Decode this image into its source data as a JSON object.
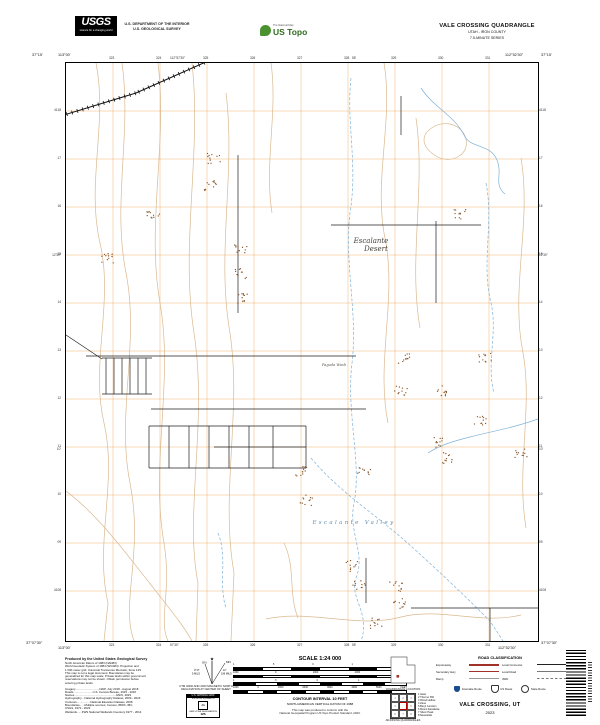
{
  "header": {
    "usgs_wordmark": "USGS",
    "usgs_tagline": "science for a changing world",
    "dept_line1": "U.S. DEPARTMENT OF THE INTERIOR",
    "dept_line2": "U.S. GEOLOGICAL SURVEY",
    "ustopo_tagline": "The National Map",
    "ustopo_brand": "US Topo",
    "quad_title": "VALE CROSSING QUADRANGLE",
    "quad_state": "UTAH - IRON COUNTY",
    "quad_series": "7.5-MINUTE SERIES"
  },
  "map_margin": {
    "corner_tl_lat": "37°15'",
    "corner_tl_lon": "113°00'",
    "corner_tr_lat": "37°15'",
    "corner_tr_lon": "112°52'30\"",
    "corner_bl_lat": "37°07'30\"",
    "corner_bl_lon": "113°00'",
    "corner_br_lat": "37°07'30\"",
    "corner_br_lon": "112°52'30\"",
    "top_ticks": [
      "323",
      "324",
      "325",
      "326",
      "327",
      "328",
      "329",
      "330",
      "331"
    ],
    "bottom_ticks": [
      "323",
      "324",
      "325",
      "326",
      "327",
      "328",
      "329",
      "330",
      "331"
    ],
    "left_ticks": [
      "4118",
      "17",
      "16",
      "15",
      "14",
      "13",
      "12",
      "11",
      "10",
      "09",
      "4108"
    ],
    "right_ticks": [
      "4118",
      "17",
      "16",
      "15",
      "14",
      "13",
      "12",
      "11",
      "10",
      "09",
      "4108"
    ],
    "top_mid_labels": [
      {
        "text": "112°57'30\"",
        "x": 170
      },
      {
        "text": "55'",
        "x": 352
      }
    ],
    "bottom_mid_labels": [
      {
        "text": "57'30\"",
        "x": 170
      },
      {
        "text": "55'",
        "x": 352
      }
    ],
    "left_mid_labels": [
      {
        "text": "12'30\"",
        "y": 253
      },
      {
        "text": "10'",
        "y": 447
      }
    ],
    "right_mid_labels": [
      {
        "text": "12'30\"",
        "y": 253
      },
      {
        "text": "10'",
        "y": 447
      }
    ]
  },
  "map": {
    "colors": {
      "grid": "#f0a55c",
      "contour": "#d8b58a",
      "stream": "#7fb2d8",
      "road": "#1f1f1f",
      "rail": "#111111",
      "speck": "#86562b"
    },
    "labels": [
      {
        "text": "Escalante",
        "x": 305,
        "y": 180,
        "cls": "phys"
      },
      {
        "text": "Desert",
        "x": 310,
        "y": 188,
        "cls": "phys"
      },
      {
        "text": "Pagoda Wash",
        "x": 268,
        "y": 303,
        "cls": "wash"
      },
      {
        "text": "Escalante Valley",
        "x": 288,
        "y": 461,
        "cls": "valley"
      }
    ],
    "features": {
      "grid_vx": [
        47,
        94,
        141,
        188,
        235,
        282,
        329,
        376,
        423
      ],
      "grid_hy": [
        48,
        96,
        144,
        192,
        240,
        288,
        336,
        384,
        432,
        480,
        528
      ],
      "railroad": [
        [
          -2,
          52,
          70,
          30
        ],
        [
          70,
          30,
          142,
          -2
        ]
      ],
      "roads": [
        [
          20,
          293,
          290,
          293
        ],
        [
          85,
          346,
          300,
          346
        ],
        [
          36,
          295,
          86,
          295
        ],
        [
          36,
          331,
          86,
          331
        ],
        [
          40,
          295,
          40,
          331
        ],
        [
          48,
          295,
          48,
          331
        ],
        [
          56,
          295,
          56,
          331
        ],
        [
          64,
          295,
          64,
          331
        ],
        [
          72,
          295,
          72,
          331
        ],
        [
          80,
          295,
          80,
          331
        ],
        [
          0,
          272,
          36,
          296
        ],
        [
          83,
          363,
          240,
          363
        ],
        [
          83,
          405,
          240,
          405
        ],
        [
          148,
          384,
          240,
          384
        ],
        [
          83,
          363,
          83,
          405
        ],
        [
          103,
          363,
          103,
          405
        ],
        [
          123,
          363,
          123,
          405
        ],
        [
          143,
          363,
          143,
          405
        ],
        [
          163,
          363,
          163,
          405
        ],
        [
          183,
          363,
          183,
          405
        ],
        [
          207,
          363,
          207,
          405
        ],
        [
          240,
          363,
          240,
          405
        ],
        [
          172,
          92,
          172,
          250
        ],
        [
          370,
          158,
          370,
          240
        ],
        [
          265,
          162,
          415,
          162
        ],
        [
          335,
          33,
          335,
          72
        ],
        [
          345,
          545,
          472,
          545
        ],
        [
          424,
          545,
          424,
          578
        ],
        [
          300,
          495,
          300,
          540
        ]
      ],
      "contours": [
        "M30,0 C42,60 20,120 34,180 C48,240 24,300 38,360 C52,420 28,480 42,540 L38,578",
        "M56,0 C66,70 46,140 60,210 C74,280 50,350 64,420 C78,490 54,540 68,578",
        "M92,0 C102,80 80,160 94,240 C108,320 84,400 98,480 C106,530 92,556 102,578",
        "M126,0 C136,90 114,180 128,270 C142,360 118,450 132,520 L130,578",
        "M160,30 C170,110 150,190 164,270 C176,350 154,430 168,510 L165,578",
        "M205,0 C212,50 198,100 206,150",
        "M318,0 C328,60 306,120 320,180 C330,240 310,300 322,360",
        "M350,55 C360,125 342,195 354,265",
        "M360,70 C374,54 396,60 400,76 C404,92 384,102 370,93 C360,87 355,79 360,70",
        "M455,95 C466,160 444,225 457,290 C467,345 450,405 460,465",
        "M200,556 C245,546 290,566 335,554 C375,544 415,562 455,552",
        "M0,428 C32,452 58,488 82,518 C102,544 116,560 126,578",
        "M218,480 C230,505 222,530 232,555"
      ],
      "streams": [
        {
          "d": "M285,15 C280,60 292,100 284,150 C278,200 292,250 286,300 C280,350 296,400 288,440 C282,470 300,490 290,515 C283,535 305,550 295,578",
          "dash": true
        },
        {
          "d": "M355,25 C368,45 388,52 398,72 C404,86 424,80 431,97 C437,111 427,121 439,131",
          "dash": false
        },
        {
          "d": "M472,356 C450,364 428,368 404,374 C388,378 374,382 362,390",
          "dash": false
        },
        {
          "d": "M245,395 C270,425 300,445 330,470 C358,494 394,528 424,558 L437,578",
          "dash": true
        },
        {
          "d": "M152,470 C162,495 152,520 160,545",
          "dash": true
        },
        {
          "d": "M420,120 C428,160 415,200 425,240 C432,270 420,300 428,330",
          "dash": true
        }
      ],
      "specks": [
        [
          148,
          96
        ],
        [
          144,
          122
        ],
        [
          87,
          153
        ],
        [
          42,
          196
        ],
        [
          175,
          185
        ],
        [
          175,
          210
        ],
        [
          175,
          236
        ],
        [
          394,
          152
        ],
        [
          339,
          295
        ],
        [
          419,
          295
        ],
        [
          335,
          328
        ],
        [
          375,
          328
        ],
        [
          235,
          408
        ],
        [
          298,
          408
        ],
        [
          240,
          437
        ],
        [
          372,
          379
        ],
        [
          380,
          395
        ],
        [
          285,
          503
        ],
        [
          293,
          523
        ],
        [
          330,
          523
        ],
        [
          333,
          540
        ],
        [
          415,
          358
        ],
        [
          455,
          390
        ],
        [
          310,
          560
        ]
      ]
    }
  },
  "footer": {
    "produced_by": "Produced by the United States Geological Survey",
    "credits": [
      "North American Datum of 1983 (NAD83)",
      "World Geodetic System of 1984 (WGS84). Projection and",
      "1 000-meter grid: Universal Transverse Mercator, Zone 12S",
      "This map is not a legal document. Boundaries may be",
      "generalized for this map scale. Private lands within government",
      "reservations may not be shown. Obtain permission before",
      "entering private lands."
    ],
    "sources": [
      "Imagery..............................NAIP, July 2018 - August 2018",
      "Roads........................U.S. Census Bureau, 2015 - 2016",
      "Names....................................................GNIS, 2023",
      "Hydrography....National Hydrography Dataset, 2009 - 2023",
      "Contours.................National Elevation Dataset, 2008",
      "Boundaries......Multiple sources; Census, IBWC, IBC,",
      "                         USGS, 1972 - 2023",
      "Wetlands......FWS National Wetlands Inventory 1977 - 2014"
    ],
    "decl_caption1": "UTM GRID AND 2023 MAGNETIC NORTH",
    "decl_caption2": "DECLINATION AT CENTER OF SHEET",
    "decl_gn": "GN",
    "decl_mn": "MN",
    "decl_gn_val": "0°17'",
    "decl_gn_mils": "5 MILS",
    "decl_mn_val": "11°",
    "decl_mn_mils": "196 MILS",
    "usng_title": "U.S. NATIONAL GRID",
    "usng_sub": "100,000-M SQUARE ID",
    "usng_square": "JG",
    "usng_zone_label": "GRID ZONE DESIGNATION",
    "usng_zone": "12S",
    "scale_title": "SCALE 1:24 000",
    "scale_bars": [
      {
        "nums": [
          "1",
          ".5",
          "0",
          "1",
          "KILOMETERS"
        ],
        "segs": 6
      },
      {
        "nums": [
          "1000",
          "0",
          "1000",
          "2000",
          "METERS"
        ],
        "segs": 6
      },
      {
        "nums": [
          "1",
          ".5",
          "0",
          "1",
          "MILES"
        ],
        "segs": 8
      },
      {
        "nums": [
          "1000",
          "0",
          "1000",
          "2000",
          "3000",
          "4000",
          "5000",
          "FEET"
        ],
        "segs": 12
      }
    ],
    "contour_line1": "CONTOUR INTERVAL 10 FEET",
    "contour_line2": "NORTH AMERICAN VERTICAL DATUM OF 1988",
    "standard_line1": "This map was produced to conform with the",
    "standard_line2": "National Geospatial Program US Topo Product Standard, 2023.",
    "quad_location_label": "QUADRANGLE LOCATION",
    "adjoining_label": "ADJOINING QUADRANGLES",
    "adjoining_cells": [
      "1",
      "2",
      "3",
      "4",
      "",
      "5",
      "6",
      "7",
      "8"
    ],
    "adjoining_names": [
      "1 Heist",
      "2 Thermo SW",
      "3 Wood Hollow",
      "4 Zane",
      "5 Beryl Junction",
      "6 Mount Escalante",
      "7 Silver Peak",
      "8 Newcastle"
    ],
    "road_class_title": "ROAD CLASSIFICATION",
    "road_class": [
      {
        "label": "Expressway",
        "style": "expressway"
      },
      {
        "label": "Local Connector",
        "style": "connector"
      },
      {
        "label": "Secondary Hwy",
        "style": "secondary"
      },
      {
        "label": "Local Road",
        "style": "local"
      },
      {
        "label": "Ramp",
        "style": "ramp"
      },
      {
        "label": "4WD",
        "style": "fourwd"
      }
    ],
    "shields": [
      {
        "type": "interstate",
        "label": "Interstate Route"
      },
      {
        "type": "us",
        "label": "US Route"
      },
      {
        "type": "state",
        "label": "State Route"
      }
    ],
    "map_name": "VALE CROSSING, UT",
    "map_year": "2023"
  }
}
